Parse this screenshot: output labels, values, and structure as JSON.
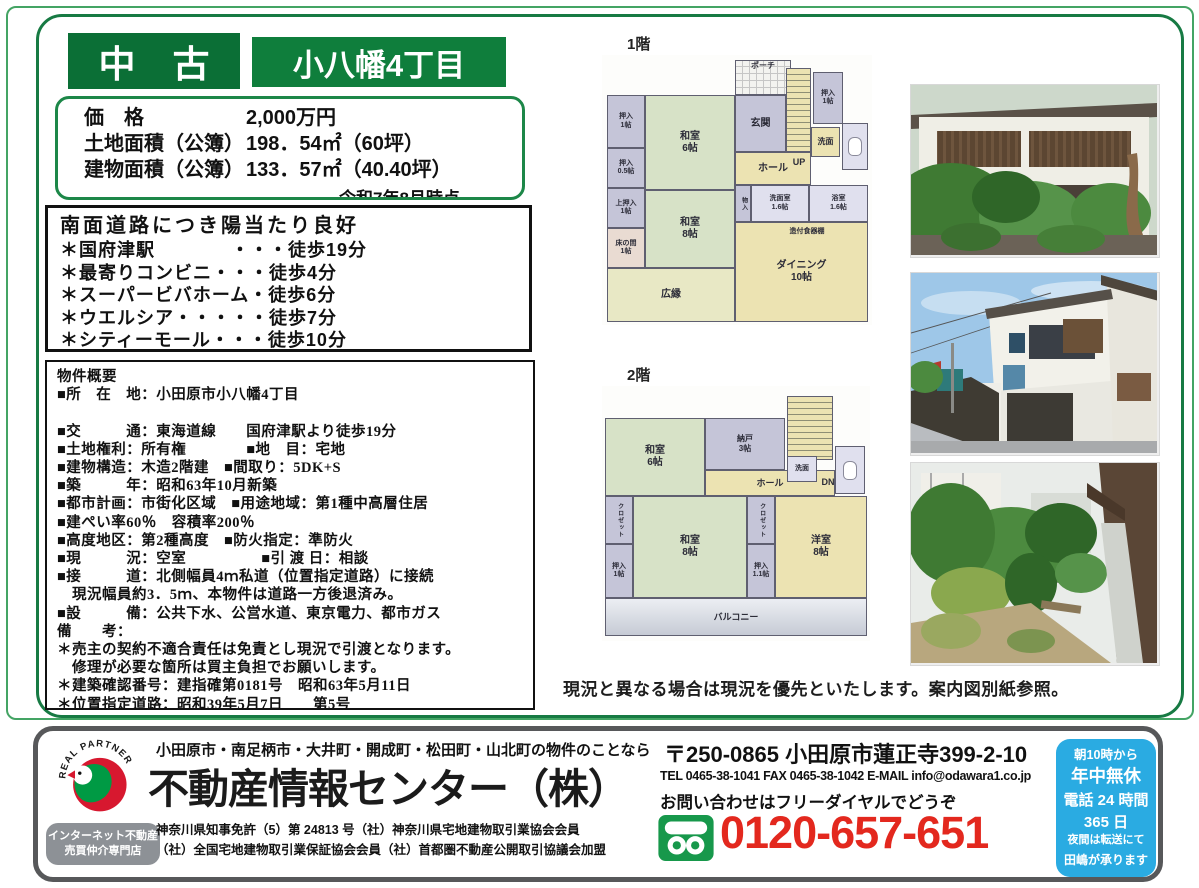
{
  "header": {
    "listing_type": "中　古",
    "location_title": "小八幡4丁目"
  },
  "price_box": {
    "rows": [
      {
        "l": "価　格",
        "v": "2,000万円"
      },
      {
        "l": "土地面積（公簿）",
        "v": "198．54㎡（60坪）"
      },
      {
        "l": "建物面積（公簿）",
        "v": "133．57㎡（40.40坪）"
      }
    ],
    "as_of": "令和7年8月時点"
  },
  "highlight_box": {
    "title": "南面道路につき陽当たり良好",
    "items": [
      "＊国府津駅　　　　・・・徒歩19分",
      "＊最寄りコンビニ・・・徒歩4分",
      "＊スーパービバホーム・徒歩6分",
      "＊ウエルシア・・・・・徒歩7分",
      "＊シティーモール・・・徒歩10分"
    ]
  },
  "overview_box": {
    "lines": [
      "物件概要",
      "■所　在　地：小田原市小八幡4丁目",
      "",
      "■交　　　通：東海道線　　国府津駅より徒歩19分",
      "■土地権利：所有権　　　　■地　目：宅地",
      "■建物構造：木造2階建　■間取り：5DK+S",
      "■築　　　年：昭和63年10月新築",
      "■都市計画：市街化区域　■用途地域：第1種中高層住居",
      "■建ぺい率60％　容積率200％",
      "■高度地区：第2種高度　■防火指定：準防火",
      "■現　　　況：空室　　　　　■引 渡 日：相談",
      "■接　　　道：北側幅員4ｍ私道（位置指定道路）に接続",
      "　現況幅員約3．5ｍ、本物件は道路一方後退済み。",
      "■設　　　備：公共下水、公営水道、東京電力、都市ガス",
      "備　　考：",
      "＊売主の契約不適合責任は免責とし現況で引渡となります。",
      "　修理が必要な箇所は買主負担でお願いします。",
      "＊建築確認番号：建指確第0181号　昭和63年5月11日",
      "＊位置指定道路：昭和39年5月7日　　第5号"
    ]
  },
  "floorplans": {
    "floor1": {
      "label": "1階",
      "rooms": [
        {
          "n": "room-porch",
          "t": "ポーチ",
          "x": 133,
          "y": 5,
          "w": 56,
          "h": 35,
          "c": "w",
          "cls": "porch",
          "fs": 8
        },
        {
          "n": "room-stairs-up",
          "t": "",
          "x": 184,
          "y": 13,
          "w": 25,
          "h": 84,
          "c": "y",
          "cls": "stairs"
        },
        {
          "n": "room-oshiire-tr",
          "t": "押入\n1帖",
          "x": 211,
          "y": 17,
          "w": 30,
          "h": 52,
          "c": "p",
          "fs": 7
        },
        {
          "n": "room-genkan",
          "t": "玄関",
          "x": 133,
          "y": 40,
          "w": 51,
          "h": 57,
          "c": "p",
          "fs": 10
        },
        {
          "n": "room-senmen-1f",
          "t": "洗面",
          "x": 209,
          "y": 72,
          "w": 29,
          "h": 30,
          "c": "y",
          "fs": 8
        },
        {
          "n": "room-toilet-1f",
          "t": "",
          "x": 240,
          "y": 68,
          "w": 26,
          "h": 47,
          "c": "l",
          "cls": "wc"
        },
        {
          "n": "room-oshiire-1jo",
          "t": "押入\n1帖",
          "x": 5,
          "y": 40,
          "w": 38,
          "h": 53,
          "c": "p",
          "fs": 7
        },
        {
          "n": "room-washitsu-6jo",
          "t": "和室\n6帖",
          "x": 43,
          "y": 40,
          "w": 90,
          "h": 95,
          "c": "g",
          "fs": 10
        },
        {
          "n": "room-oshiire-05jo",
          "t": "押入\n0.5帖",
          "x": 5,
          "y": 93,
          "w": 38,
          "h": 40,
          "c": "p",
          "fs": 7
        },
        {
          "n": "room-kamioshiire",
          "t": "上押入\n1帖",
          "x": 5,
          "y": 133,
          "w": 38,
          "h": 40,
          "c": "p",
          "fs": 7
        },
        {
          "n": "room-tokonoma",
          "t": "床の間\n1帖",
          "x": 5,
          "y": 173,
          "w": 38,
          "h": 40,
          "c": "k",
          "fs": 7
        },
        {
          "n": "room-washitsu-8jo",
          "t": "和室\n8帖",
          "x": 43,
          "y": 135,
          "w": 90,
          "h": 78,
          "c": "g",
          "fs": 10
        },
        {
          "n": "room-hall-1f",
          "t": "ホール",
          "x": 133,
          "y": 97,
          "w": 76,
          "h": 33,
          "c": "y",
          "fs": 10
        },
        {
          "n": "label-up",
          "t": "UP",
          "x": 184,
          "y": 99,
          "w": 26,
          "h": 16,
          "c": "n",
          "fs": 9
        },
        {
          "n": "room-monoire",
          "t": "物入",
          "x": 133,
          "y": 130,
          "w": 16,
          "h": 37,
          "c": "p",
          "fs": 6,
          "cls": "vert"
        },
        {
          "n": "room-senmenshitsu",
          "t": "洗面室\n1.6帖",
          "x": 149,
          "y": 130,
          "w": 58,
          "h": 37,
          "c": "l",
          "fs": 7
        },
        {
          "n": "room-yokushitsu",
          "t": "浴室\n1.6帖",
          "x": 207,
          "y": 130,
          "w": 59,
          "h": 37,
          "c": "l",
          "fs": 7
        },
        {
          "n": "room-dining",
          "t": "ダイニング\n10帖",
          "x": 133,
          "y": 167,
          "w": 133,
          "h": 100,
          "c": "y",
          "fs": 10
        },
        {
          "n": "label-cupboard",
          "t": "造付食器棚",
          "x": 160,
          "y": 171,
          "w": 90,
          "h": 12,
          "c": "n",
          "fs": 7
        },
        {
          "n": "room-engawa",
          "t": "広縁",
          "x": 5,
          "y": 213,
          "w": 128,
          "h": 54,
          "c": "e",
          "fs": 10
        }
      ]
    },
    "floor2": {
      "label": "2階",
      "rooms": [
        {
          "n": "room-stairs-down",
          "t": "",
          "x": 185,
          "y": 10,
          "w": 46,
          "h": 64,
          "c": "y",
          "cls": "stairs"
        },
        {
          "n": "room-washitsu2-6jo",
          "t": "和室\n6帖",
          "x": 3,
          "y": 32,
          "w": 100,
          "h": 78,
          "c": "g",
          "fs": 10
        },
        {
          "n": "room-nando",
          "t": "納戸\n3帖",
          "x": 103,
          "y": 32,
          "w": 80,
          "h": 52,
          "c": "p",
          "fs": 8
        },
        {
          "n": "room-hall-2f",
          "t": "ホール",
          "x": 103,
          "y": 84,
          "w": 130,
          "h": 26,
          "c": "y",
          "fs": 9
        },
        {
          "n": "room-senmen-2f",
          "t": "洗面",
          "x": 185,
          "y": 70,
          "w": 30,
          "h": 26,
          "c": "l",
          "fs": 7
        },
        {
          "n": "room-toilet-2f",
          "t": "",
          "x": 233,
          "y": 60,
          "w": 30,
          "h": 48,
          "c": "l",
          "cls": "wc"
        },
        {
          "n": "label-dn",
          "t": "DN",
          "x": 213,
          "y": 88,
          "w": 26,
          "h": 16,
          "c": "n",
          "fs": 9
        },
        {
          "n": "room-closet-left",
          "t": "クロゼット",
          "x": 3,
          "y": 110,
          "w": 28,
          "h": 48,
          "c": "p",
          "fs": 6,
          "cls": "vert"
        },
        {
          "n": "room-oshiire2-1jo",
          "t": "押入\n1帖",
          "x": 3,
          "y": 158,
          "w": 28,
          "h": 54,
          "c": "p",
          "fs": 7
        },
        {
          "n": "room-washitsu2-8jo",
          "t": "和室\n8帖",
          "x": 31,
          "y": 110,
          "w": 114,
          "h": 102,
          "c": "g",
          "fs": 10
        },
        {
          "n": "room-closet-center",
          "t": "クロゼット",
          "x": 145,
          "y": 110,
          "w": 28,
          "h": 48,
          "c": "p",
          "fs": 6,
          "cls": "vert"
        },
        {
          "n": "room-oshiire2-11jo",
          "t": "押入\n1.1帖",
          "x": 145,
          "y": 158,
          "w": 28,
          "h": 54,
          "c": "p",
          "fs": 7
        },
        {
          "n": "room-youshitsu-8jo",
          "t": "洋室\n8帖",
          "x": 173,
          "y": 110,
          "w": 92,
          "h": 102,
          "c": "y",
          "fs": 10
        },
        {
          "n": "room-balcony",
          "t": "バルコニー",
          "x": 3,
          "y": 212,
          "w": 262,
          "h": 38,
          "c": "w",
          "cls": "balcony",
          "fs": 9
        }
      ]
    }
  },
  "photos": [
    "exterior-front",
    "exterior-side",
    "garden"
  ],
  "plan_caption": "現況と異なる場合は現況を優先といたします。案内図別紙参照。",
  "footer": {
    "logo_text": "REAL PARTNER",
    "badge_lines": [
      "インターネット不動産",
      "売買仲介専門店"
    ],
    "area_line": "小田原市・南足柄市・大井町・開成町・松田町・山北町の物件のことなら",
    "company": "不動産情報センター（株）",
    "license_line1": "神奈川県知事免許（5）第 24813 号（社）神奈川県宅地建物取引業協会会員",
    "license_line2": "（社）全国宅地建物取引業保証協会会員（社）首都圏不動産公開取引協議会加盟",
    "postal": "〒250-0865 小田原市蓮正寺399-2-10",
    "tel_line": "TEL 0465-38-1041 FAX 0465-38-1042 E-MAIL info@odawara1.co.jp",
    "inquiry": "お問い合わせはフリーダイヤルでどうぞ",
    "freedial": "0120-657-651",
    "hours_box": {
      "lines": [
        "朝10時から",
        "年中無休",
        "電話 24 時間",
        "365 日",
        "夜間は転送にて",
        "田嶋が承ります"
      ]
    }
  },
  "colors": {
    "brand_green_dark": "#0b6f36",
    "brand_green": "#0f7e3c",
    "frame_green": "#177a43",
    "freedial_red": "#e3281e",
    "hours_blue": "#2aabe2"
  }
}
